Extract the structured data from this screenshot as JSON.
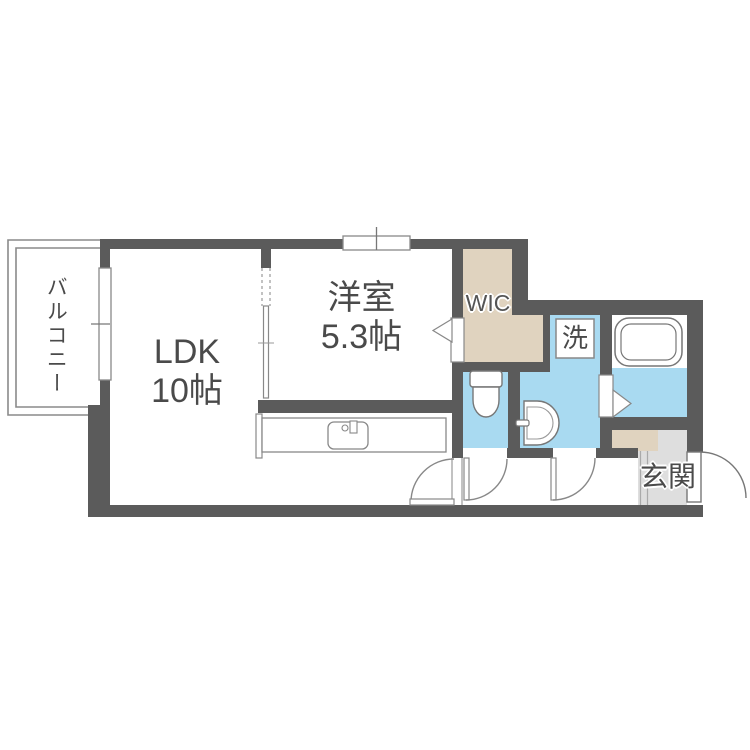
{
  "floorplan": {
    "rooms": {
      "balcony": {
        "label": "バルコニー"
      },
      "ldk": {
        "label": "LDK",
        "size": "10帖"
      },
      "western_room": {
        "label": "洋室",
        "size": "5.3帖"
      },
      "wic": {
        "label": "WIC"
      },
      "laundry": {
        "label": "洗"
      },
      "entrance": {
        "label": "玄関"
      }
    },
    "colors": {
      "wall": "#5B5B5B",
      "wet_area_floor": "#A9DAF1",
      "closet_floor": "#E0D3BF",
      "entrance_floor": "#DEDEDE",
      "fixture_outline": "#888888",
      "label_text": "#4A4A4A"
    }
  }
}
